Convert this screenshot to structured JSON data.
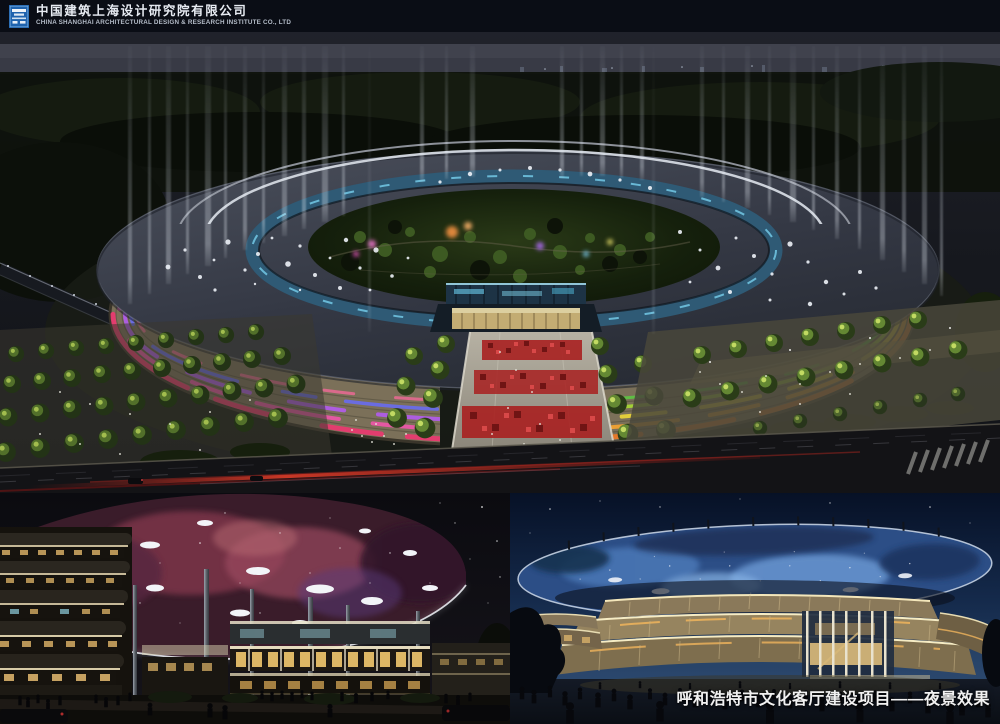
{
  "header": {
    "company_name_zh": "中国建筑上海设计研究院有限公司",
    "company_name_en": "CHINA SHANGHAI ARCHITECTURAL DESIGN & RESEARCH INSTITUTE CO., LTD",
    "logo_icon": "company-emblem",
    "bar_color": "#0a0d15",
    "logo_color": "#1f63ae"
  },
  "caption": {
    "text": "呼和浩特市文化客厅建设项目——夜景效果",
    "color": "#f1f1f1"
  },
  "colors": {
    "night_sky": "#17191f",
    "ring_roof_slate": "#3a3e48",
    "inner_ring_glass": "#2f5a75",
    "left_wing_light_bands": [
      "#e83b70",
      "#ea57a6",
      "#b05ce8",
      "#6a6ce8",
      "#e06a8e"
    ],
    "right_wing_light_bands": [
      "#ea7a28",
      "#f0a232",
      "#e8d23a",
      "#a6d636",
      "#5ec244"
    ],
    "red_paving": "#a82020",
    "nebula_canopy": "#7c3448",
    "blue_canopy": "#2c4e86",
    "warm_facade_light": "#f4e7bb",
    "road_light_trail": "#c03028"
  }
}
